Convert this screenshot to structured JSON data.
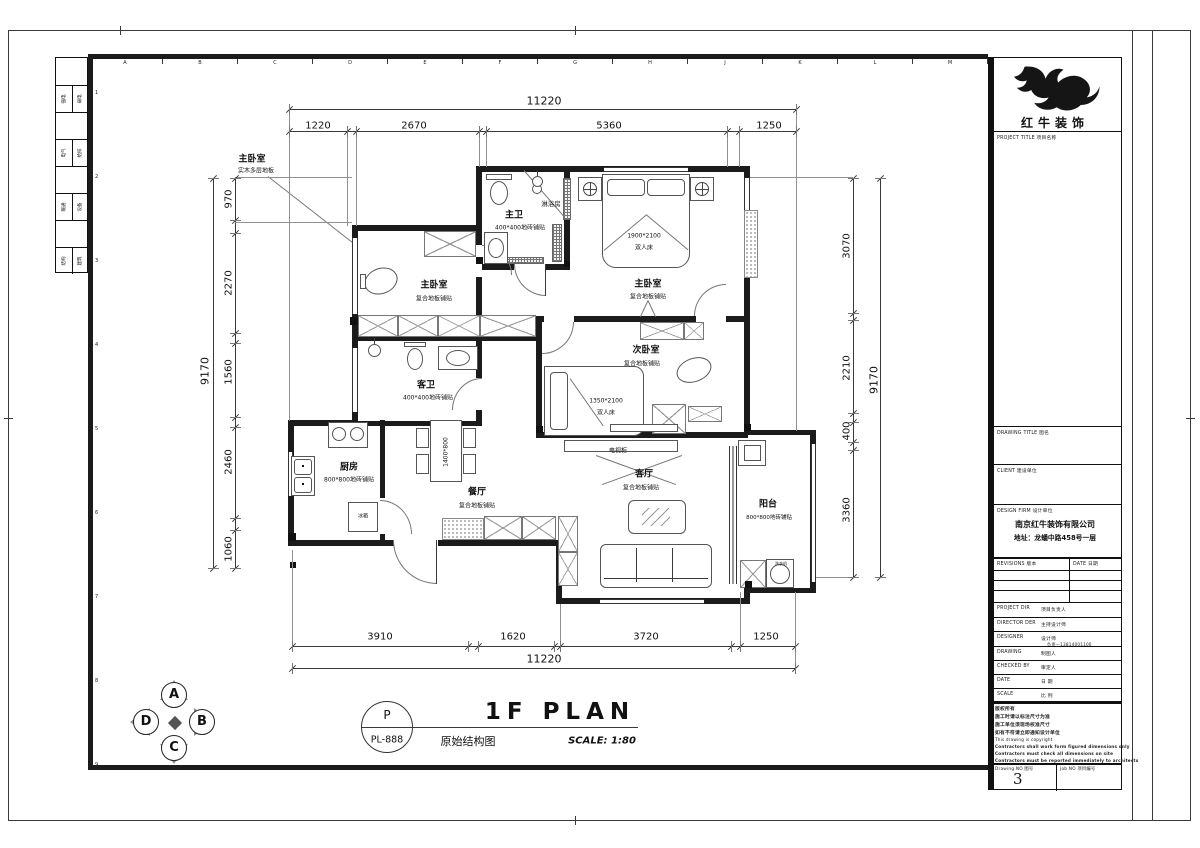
{
  "sheet": {
    "grid_letters": [
      "A",
      "B",
      "C",
      "D",
      "E",
      "F",
      "G",
      "H",
      "J",
      "K",
      "L",
      "M"
    ],
    "row_numbers": [
      "1",
      "2",
      "3",
      "4",
      "5",
      "6",
      "7",
      "8",
      "9"
    ],
    "strip_rows": [
      [
        "强电",
        "弱电"
      ],
      [
        "电气",
        "给排"
      ],
      [
        "暖通",
        "设备"
      ],
      [
        "结构",
        "建筑"
      ]
    ]
  },
  "titleblock": {
    "brand": "红牛装饰",
    "project_title_label": "PROJECT TITLE  项目名称",
    "drawing_title_label": "DRAWING TITLE  图名",
    "client_label": "CLIENT  建设单位",
    "design_firm_label": "DESIGN FIRM  设计单位",
    "design_firm_name": "南京红牛装饰有限公司",
    "design_firm_address": "地址：龙蟠中路458号一层",
    "revisions_label": "REVISIONS  版本",
    "date_col_label": "DATE  日期",
    "rows": [
      {
        "label": "PROJECT DIR",
        "zh": "项目负责人"
      },
      {
        "label": "DIRECTOR DER",
        "zh": "主持设计师"
      },
      {
        "label": "DESIGNER",
        "zh": "设计师",
        "note": "负责—13814001100"
      },
      {
        "label": "DRAWING",
        "zh": "制图人"
      },
      {
        "label": "CHECKED BY",
        "zh": "审定人"
      },
      {
        "label": "DATE",
        "zh": "日  期"
      },
      {
        "label": "SCALE",
        "zh": "比  例"
      }
    ],
    "copyright": [
      "版权所有",
      "施工时请以标注尺寸为准",
      "施工单位须现场校准尺寸",
      "如有不符请立即通知设计单位",
      "This drawing is copyright",
      "Contractors shall work form figured dimensions only",
      "Contractors must check all dimensions on site",
      "Contractors must be reported immediately to architects"
    ],
    "drawing_no_label": "Drawing NO  图号",
    "drawing_no": "3",
    "job_no_label": "Job NO  项目编号"
  },
  "footer": {
    "compass_letters": [
      "A",
      "B",
      "C",
      "D"
    ],
    "bubble_top": "P",
    "bubble_bottom": "PL-888",
    "title": "1F PLAN",
    "subtitle": "原始结构图",
    "scale": "SCALE: 1:80"
  },
  "plan": {
    "dimensions": {
      "top": {
        "total": "11220",
        "segments": [
          "1220",
          "2670",
          "5360",
          "1250"
        ]
      },
      "bottom": {
        "total": "11220",
        "segments": [
          "3910",
          "1620",
          "3720",
          "1250"
        ]
      },
      "left": {
        "total": "9170",
        "segments": [
          "970",
          "2270",
          "1560",
          "2460",
          "1060"
        ]
      },
      "right": {
        "total": "9170",
        "segments": [
          "3070",
          "2210",
          "400",
          "3360"
        ]
      }
    },
    "rooms": [
      {
        "name": "主卧室",
        "floor": "实木多层地板"
      },
      {
        "name": "主卫",
        "floor": "400*400地砖铺贴"
      },
      {
        "name": "淋浴房"
      },
      {
        "name": "主卧室",
        "floor": "复合地板铺贴",
        "bed": "1900*2100 双人床"
      },
      {
        "name": "主卧室",
        "floor": "复合地板铺贴"
      },
      {
        "name": "客卫",
        "floor": "400*400地砖铺贴"
      },
      {
        "name": "次卧室",
        "floor": "复合地板铺贴",
        "bed": "1350*2100 双人床"
      },
      {
        "name": "厨房",
        "floor": "800*800地砖铺贴"
      },
      {
        "name": "餐厅",
        "floor": "复合地板铺贴",
        "table": "1400*800"
      },
      {
        "name": "客厅",
        "floor": "复合地板铺贴",
        "cabinet": "电视柜"
      },
      {
        "name": "阳台",
        "floor": "800*800地砖铺贴",
        "appliance": "洗衣机"
      }
    ],
    "labels": [
      {
        "t": "11220",
        "x": 544,
        "y": 101,
        "fs": 11,
        "n": "dim-top-total"
      },
      {
        "t": "1220",
        "x": 318,
        "y": 126,
        "fs": 10,
        "n": "dim-top"
      },
      {
        "t": "2670",
        "x": 414,
        "y": 126,
        "fs": 10,
        "n": "dim-top"
      },
      {
        "t": "5360",
        "x": 609,
        "y": 126,
        "fs": 10,
        "n": "dim-top"
      },
      {
        "t": "1250",
        "x": 769,
        "y": 126,
        "fs": 10,
        "n": "dim-top"
      },
      {
        "t": "3910",
        "x": 380,
        "y": 637,
        "fs": 10,
        "n": "dim-bottom"
      },
      {
        "t": "1620",
        "x": 513,
        "y": 637,
        "fs": 10,
        "n": "dim-bottom"
      },
      {
        "t": "3720",
        "x": 646,
        "y": 637,
        "fs": 10,
        "n": "dim-bottom"
      },
      {
        "t": "1250",
        "x": 766,
        "y": 637,
        "fs": 10,
        "n": "dim-bottom"
      },
      {
        "t": "11220",
        "x": 544,
        "y": 659,
        "fs": 11,
        "n": "dim-bottom-total"
      },
      {
        "t": "9170",
        "x": 205,
        "y": 371,
        "fs": 11,
        "r": -90,
        "n": "dim-left-total"
      },
      {
        "t": "970",
        "x": 229,
        "y": 199,
        "fs": 10,
        "r": -90,
        "n": "dim-left"
      },
      {
        "t": "2270",
        "x": 229,
        "y": 283,
        "fs": 10,
        "r": -90,
        "n": "dim-left"
      },
      {
        "t": "1560",
        "x": 229,
        "y": 372,
        "fs": 10,
        "r": -90,
        "n": "dim-left"
      },
      {
        "t": "2460",
        "x": 229,
        "y": 462,
        "fs": 10,
        "r": -90,
        "n": "dim-left"
      },
      {
        "t": "1060",
        "x": 229,
        "y": 549,
        "fs": 10,
        "r": -90,
        "n": "dim-left"
      },
      {
        "t": "9170",
        "x": 874,
        "y": 380,
        "fs": 11,
        "r": -90,
        "n": "dim-right-total"
      },
      {
        "t": "3070",
        "x": 847,
        "y": 246,
        "fs": 10,
        "r": -90,
        "n": "dim-right"
      },
      {
        "t": "2210",
        "x": 847,
        "y": 368,
        "fs": 10,
        "r": -90,
        "n": "dim-right"
      },
      {
        "t": "400",
        "x": 847,
        "y": 431,
        "fs": 10,
        "r": -90,
        "n": "dim-right"
      },
      {
        "t": "3360",
        "x": 847,
        "y": 510,
        "fs": 10,
        "r": -90,
        "n": "dim-right"
      },
      {
        "t": "主卧室",
        "x": 252,
        "y": 158,
        "fs": 9,
        "b": 1,
        "n": "room-label"
      },
      {
        "t": "实木多层地板",
        "x": 256,
        "y": 170,
        "fs": 6,
        "n": "floor-label"
      },
      {
        "t": "主卫",
        "x": 514,
        "y": 214,
        "fs": 9,
        "b": 1,
        "n": "room-label"
      },
      {
        "t": "400*400地砖铺贴",
        "x": 520,
        "y": 227,
        "fs": 6,
        "n": "floor-label"
      },
      {
        "t": "淋浴房",
        "x": 551,
        "y": 203,
        "fs": 6.5,
        "n": "room-label"
      },
      {
        "t": "主卧室",
        "x": 648,
        "y": 283,
        "fs": 9,
        "b": 1,
        "n": "room-label"
      },
      {
        "t": "复合地板铺贴",
        "x": 648,
        "y": 296,
        "fs": 6,
        "n": "floor-label"
      },
      {
        "t": "1900*2100",
        "x": 644,
        "y": 236,
        "fs": 6,
        "n": "bed-size-label"
      },
      {
        "t": "双人床",
        "x": 644,
        "y": 247,
        "fs": 6,
        "n": "bed-label"
      },
      {
        "t": "主卧室",
        "x": 434,
        "y": 284,
        "fs": 9,
        "b": 1,
        "n": "room-label"
      },
      {
        "t": "复合地板铺贴",
        "x": 434,
        "y": 298,
        "fs": 6,
        "n": "floor-label"
      },
      {
        "t": "客卫",
        "x": 426,
        "y": 384,
        "fs": 9,
        "b": 1,
        "n": "room-label"
      },
      {
        "t": "400*400地砖铺贴",
        "x": 428,
        "y": 397,
        "fs": 6,
        "n": "floor-label"
      },
      {
        "t": "次卧室",
        "x": 646,
        "y": 349,
        "fs": 9,
        "b": 1,
        "n": "room-label"
      },
      {
        "t": "复合地板铺贴",
        "x": 642,
        "y": 363,
        "fs": 6,
        "n": "floor-label"
      },
      {
        "t": "1350*2100",
        "x": 606,
        "y": 401,
        "fs": 6,
        "n": "bed-size-label"
      },
      {
        "t": "双人床",
        "x": 606,
        "y": 412,
        "fs": 6,
        "n": "bed-label"
      },
      {
        "t": "厨房",
        "x": 349,
        "y": 466,
        "fs": 9,
        "b": 1,
        "n": "room-label"
      },
      {
        "t": "800*800地砖铺贴",
        "x": 349,
        "y": 479,
        "fs": 6,
        "n": "floor-label"
      },
      {
        "t": "餐厅",
        "x": 477,
        "y": 491,
        "fs": 9,
        "b": 1,
        "n": "room-label"
      },
      {
        "t": "复合地板铺贴",
        "x": 477,
        "y": 505,
        "fs": 6,
        "n": "floor-label"
      },
      {
        "t": "1400*800",
        "x": 446,
        "y": 452,
        "fs": 6,
        "r": -90,
        "n": "table-size-label"
      },
      {
        "t": "客厅",
        "x": 644,
        "y": 473,
        "fs": 9,
        "b": 1,
        "n": "room-label"
      },
      {
        "t": "复合地板铺贴",
        "x": 641,
        "y": 487,
        "fs": 6,
        "n": "floor-label"
      },
      {
        "t": "电视柜",
        "x": 618,
        "y": 450,
        "fs": 6,
        "n": "tv-cabinet-label"
      },
      {
        "t": "阳台",
        "x": 768,
        "y": 503,
        "fs": 9,
        "b": 1,
        "n": "room-label"
      },
      {
        "t": "800*800地砖铺贴",
        "x": 769,
        "y": 517,
        "fs": 5.5,
        "n": "floor-label"
      },
      {
        "t": "冰箱",
        "x": 363,
        "y": 516,
        "fs": 5,
        "n": "fridge-label"
      },
      {
        "t": "洗衣机",
        "x": 781,
        "y": 564,
        "fs": 4,
        "n": "washer-label"
      }
    ]
  }
}
